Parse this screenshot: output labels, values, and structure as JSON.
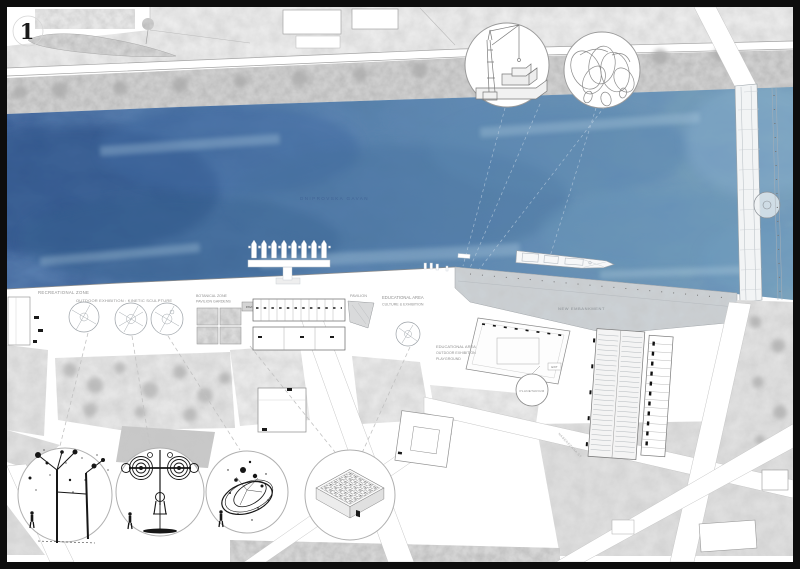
{
  "sheet": {
    "number": "1"
  },
  "colors": {
    "frame": "#0d0d0d",
    "paper": "#ffffff",
    "water_dark": "#41649a",
    "water_mid": "#5d87ae",
    "water_light": "#7ca4bd",
    "promenade": "#ccd1d5",
    "land": "#e3e3e3",
    "ink": "#161616",
    "outline": "#8a8a8a"
  },
  "labels": {
    "water_name": "DNIPROVSKA GAVAN",
    "recreational_zone": "RECREATIONAL ZONE",
    "outdoor_exhibition_kinetic": "OUTDOOR EXHIBITION : KINETIC SCULPTURE",
    "botanical_zone": "BOTANICAL ZONE",
    "pavilion_gardens": "PAVILION GARDENS",
    "pavilion": "PAVILION",
    "educational_area": "EDUCATIONAL AREA",
    "culture_exhibition": "CULTURE & EXHIBITION",
    "outdoor_exhibition": "OUTDOOR EXHIBITION",
    "playground": "PLAYGROUND",
    "new_embankment": "NEW EMBANKMENT",
    "planetarium": "PLANETARIUM",
    "exit": "EXIT",
    "street_name": "NABEREZHNA ST"
  },
  "callouts": {
    "top": [
      "harbor-crane-sketch",
      "ribbon-sculpture-sketch"
    ],
    "bottom": [
      "mobile-sculpture-sketch",
      "kinetic-rings-sculpture-sketch",
      "spiral-sculpture-sketch",
      "maze-pavilion-axonometric"
    ]
  }
}
